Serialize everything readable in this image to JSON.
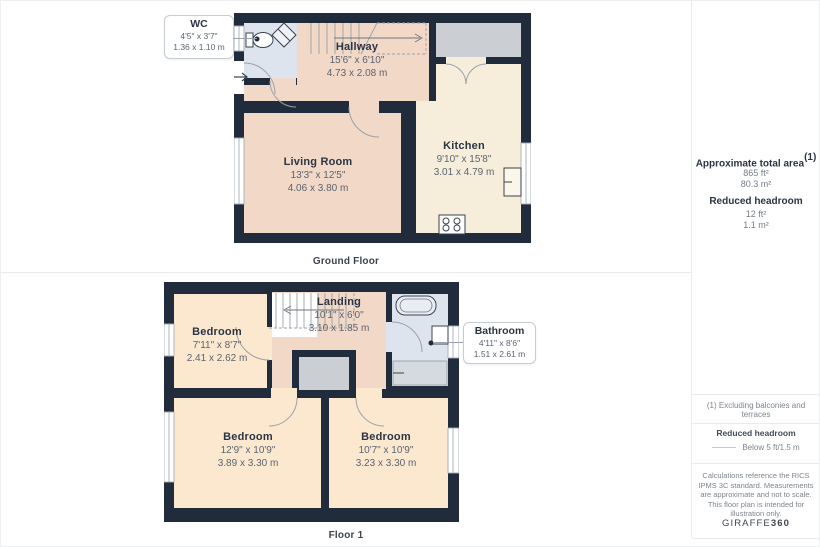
{
  "page": {
    "ground_caption": "Ground Floor",
    "floor1_caption": "Floor 1"
  },
  "ground": {
    "rooms": {
      "wc": {
        "name": "WC",
        "ft": "4'5\" x 3'7\"",
        "m": "1.36 x 1.10 m"
      },
      "hallway": {
        "name": "Hallway",
        "ft": "15'6\" x 6'10\"",
        "m": "4.73 x 2.08 m"
      },
      "living": {
        "name": "Living Room",
        "ft": "13'3\" x 12'5\"",
        "m": "4.06 x 3.80 m"
      },
      "kitchen": {
        "name": "Kitchen",
        "ft": "9'10\" x 15'8\"",
        "m": "3.01 x 4.79 m"
      }
    }
  },
  "floor1": {
    "rooms": {
      "bedroom_top": {
        "name": "Bedroom",
        "ft": "7'11\" x 8'7\"",
        "m": "2.41 x 2.62 m"
      },
      "landing": {
        "name": "Landing",
        "ft": "10'1\" x 6'0\"",
        "m": "3.10 x 1.85 m"
      },
      "bathroom": {
        "name": "Bathroom",
        "ft": "4'11\" x 8'6\"",
        "m": "1.51 x 2.61 m"
      },
      "bedroom_left": {
        "name": "Bedroom",
        "ft": "12'9\" x 10'9\"",
        "m": "3.89 x 3.30 m"
      },
      "bedroom_right": {
        "name": "Bedroom",
        "ft": "10'7\" x 10'9\"",
        "m": "3.23 x 3.30 m"
      }
    }
  },
  "sidebar": {
    "total_area_heading": "Approximate total area",
    "total_area_superscript": "(1)",
    "total_area_ft": "865 ft²",
    "total_area_m": "80.3 m²",
    "reduced_heading": "Reduced headroom",
    "reduced_ft": "12 ft²",
    "reduced_m": "1.1 m²",
    "footnote": "(1) Excluding balconies and terraces",
    "legend_heading": "Reduced headroom",
    "legend_label": "Below 5 ft/1.5 m",
    "disclaimer": "Calculations reference the RICS IPMS 3C standard. Measurements are approximate and not to scale. This floor plan is intended for illustration only.",
    "brand_name": "GIRAFFE",
    "brand_suffix": "360"
  },
  "colors": {
    "wall": "#202c3b",
    "hall_peach": "#f2d8c6",
    "kitchen_cream": "#f6eeda",
    "bedroom_cream": "#fbe8cf",
    "bathroom_blue": "#dee4ee",
    "storage_gray": "#cbced3"
  }
}
